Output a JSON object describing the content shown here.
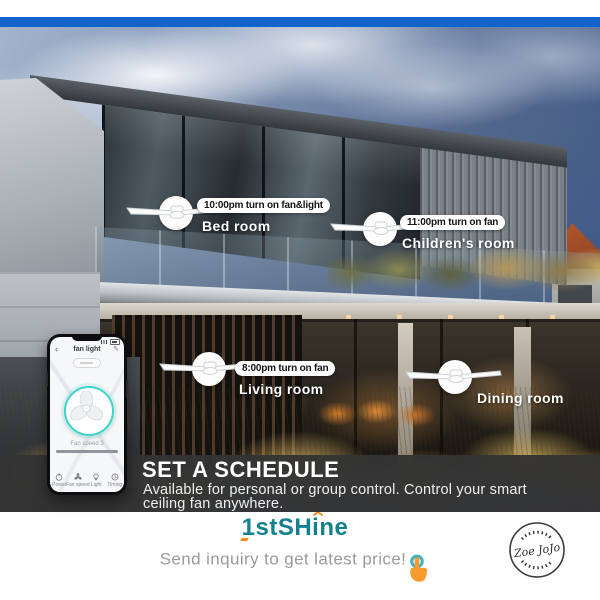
{
  "header": {
    "stripe_color": "#1264cb"
  },
  "callouts": [
    {
      "time": "10:00pm turn on fan&light",
      "room": "Bed room"
    },
    {
      "time": "11:00pm turn on fan",
      "room": "Children's room"
    },
    {
      "time": "8:00pm turn on fan",
      "room": "Living room"
    },
    {
      "time": "6:00pm turn on fan&light",
      "room": "Dining room"
    }
  ],
  "banner": {
    "title": "SET A SCHEDULE",
    "desc1": "Available for personal or group control. Control your smart",
    "desc2": "ceiling fan anywhere."
  },
  "phone": {
    "title": "fan light",
    "slider_label": "Fan speed 3",
    "nav": [
      {
        "label": "Power"
      },
      {
        "label": "Fan speed"
      },
      {
        "label": "Light"
      },
      {
        "label": "Timing"
      }
    ]
  },
  "footer": {
    "brand": "1stSHine",
    "inquiry": "Send inquiry to get latest price!",
    "stamp": "Zoe JoJo"
  },
  "icons": {
    "fan_badge": "ceiling-fan-icon",
    "tap_hand": "tap-hand-icon",
    "sparkle": "sparkle-icon",
    "stamp_seal": "zoejojo-stamp"
  },
  "colors": {
    "stripe": "#1264cb",
    "banner_bg": "#343434",
    "brand_teal": "#14818f",
    "accent_orange": "#f5891d",
    "ring_teal": "#3fd4c8"
  }
}
